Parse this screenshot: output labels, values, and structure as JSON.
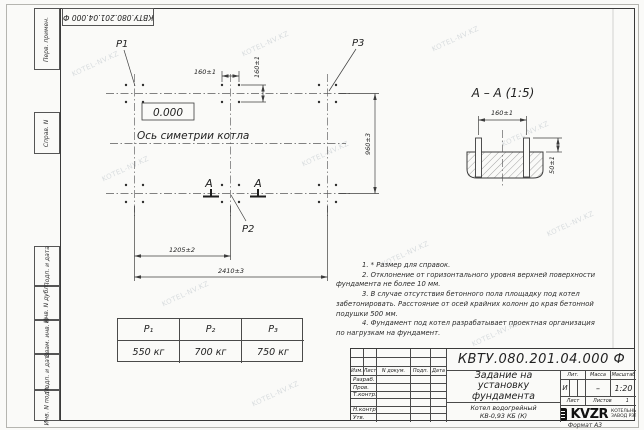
{
  "watermark": {
    "text": "KOTEL-NV.KZ"
  },
  "doc": {
    "number": "КВТУ.080.201.04.000  Ф"
  },
  "margin": {
    "perv": "Перв. примен.",
    "sprav": "Справ. N",
    "podp_data_1": "Подп. и дата",
    "inv_dubl": "Инв. N дубл.",
    "vzam_inv": "Взам. инв. N",
    "podp_data_2": "Подп. и дата",
    "inv_podl": "Инв. N подл."
  },
  "plan": {
    "p1": "P1",
    "p2": "P2",
    "p3": "P3",
    "elevation": "0.000",
    "axis_label": "Ось симетрии котла",
    "dim_160h": "160±1",
    "dim_160v": "160±1",
    "dim_960": "960±3",
    "dim_1205": "1205±2",
    "dim_2410": "2410±3",
    "section_letter": "А"
  },
  "section": {
    "title": "А – А (1:5)",
    "dim_160": "160±1",
    "dim_50": "50±1"
  },
  "notes": {
    "lines": [
      "1. * Размер для справок.",
      "2. Отклонение от горизонтального уровня верхней поверхности",
      "фундамента не более 10 мм.",
      "3. В случае отсутствия бетонного пола площадку под котел",
      "забетонировать. Расстояние от осей крайних колонн до края бетонной",
      "подушки 500 мм.",
      "4. Фундамент под котел разрабатывает проектная организация",
      "по нагрузкам на фундамент."
    ]
  },
  "loads": {
    "headers": [
      "P₁",
      "P₂",
      "P₃"
    ],
    "values": [
      "550 кг",
      "700 кг",
      "750 кг"
    ]
  },
  "titleblock": {
    "title_lines": [
      "Задание на",
      "установку",
      "фундамента"
    ],
    "product_lines": [
      "Котел водогрейный",
      "КВ-0,93 КБ (К)"
    ],
    "cols": [
      "Изм.",
      "Лист",
      "N докум.",
      "Подп.",
      "Дата"
    ],
    "rows": [
      "Разраб.",
      "Пров.",
      "Т.контр.",
      "",
      "Н.контр.",
      "Утв."
    ],
    "lit_label": "Лит.",
    "mass_label": "Масса",
    "scale_label": "Масштаб",
    "lit_value": "И",
    "mass_value": "–",
    "scale_value": "1:20",
    "sheet_label": "Лист",
    "sheets_label": "Листов",
    "sheets_value": "1",
    "logo": "KVZR",
    "logo_sub1": "КОТЕЛЬНЫЙ",
    "logo_sub2": "ЗАВОД РЭП",
    "format": "Формат А3"
  }
}
